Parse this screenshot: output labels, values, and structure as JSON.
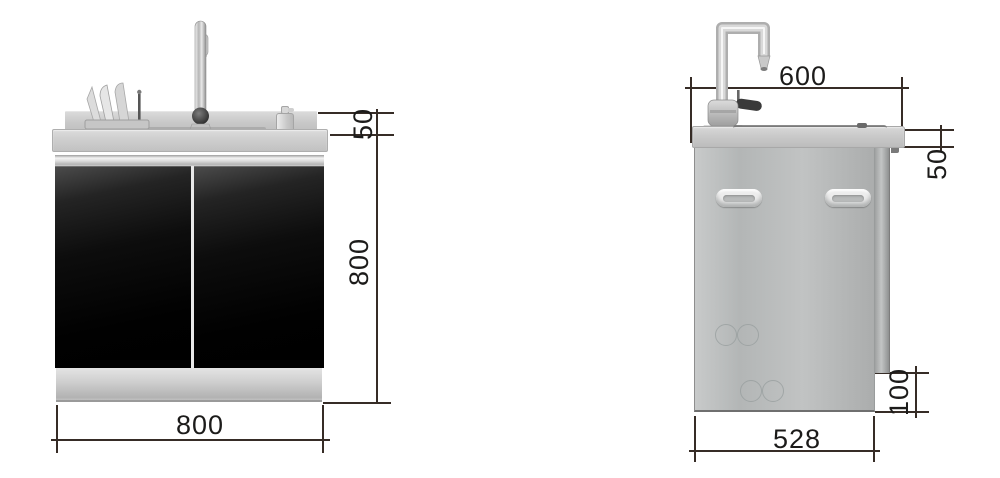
{
  "drawing": {
    "name": "stainless-sink-cabinet-dimension-drawing",
    "views": {
      "left": "front-view",
      "right": "side-view"
    }
  },
  "front_view": {
    "dimensions": {
      "backsplash_height": "50",
      "height": "800",
      "width": "800"
    }
  },
  "side_view": {
    "dimensions": {
      "depth": "600",
      "counter_thickness": "50",
      "toe_kick_height": "100",
      "bottom_depth": "528"
    }
  },
  "colors": {
    "dimension_line": "#362c26",
    "dimension_text": "#1c1b1a",
    "door_panel": "#0a0a0a",
    "stainless_light": "#cdcdcd",
    "stainless_mid": "#b5b8b8"
  }
}
